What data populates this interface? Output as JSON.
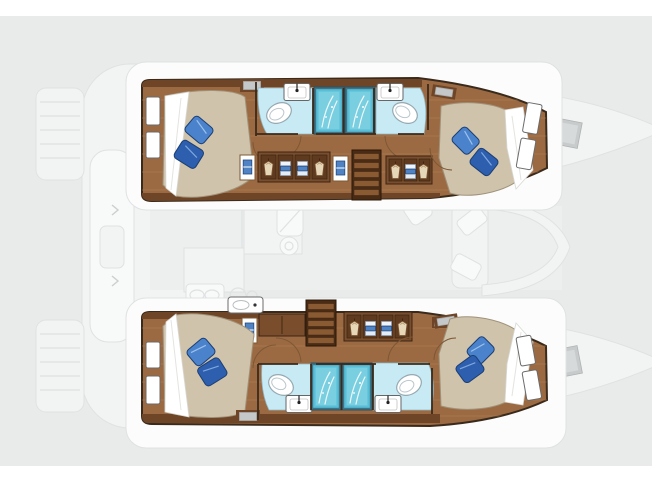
{
  "image": {
    "kind": "yacht-deck-plan",
    "description": "Top-down layout plan of a 4-cabin sailing catamaran; lower-deck hull interiors rendered in color over a ghosted main-deck outline",
    "visible_text": ""
  },
  "palette": {
    "background": "#e9ebea",
    "page_strip": "#ffffff",
    "deck_white": "#fcfcfc",
    "ghost_fill": "#f4f5f5",
    "ghost_line": "#dfe2e2",
    "wood": "#9c6a42",
    "wood_light": "#b4835a",
    "wood_dark": "#6e4526",
    "cabinet": "#7a4e2c",
    "wall": "#3a2a1b",
    "mattress": "#cfc3ac",
    "sheet": "#ffffff",
    "pillow_light": "#4a83cb",
    "pillow_dark": "#2d5fae",
    "bath_floor": "#c8eaf5",
    "shower_fill": "#57bfd8",
    "shower_pane": "#7fd0e2",
    "shower_frame": "#3f7386",
    "stairs_dark": "#4a2c14",
    "stairs_slat": "#8a5a33",
    "hatch_gray": "#c5c8c9",
    "fixture_white": "#ffffff"
  },
  "plan": {
    "hulls": [
      {
        "id": "upper-hull",
        "rooms": [
          {
            "name": "aft-double-cabin",
            "pillows": 2,
            "hull_windows": 2,
            "bed": "double-berth"
          },
          {
            "name": "aft-bathroom",
            "fixtures": [
              "toilet",
              "sink",
              "shower"
            ]
          },
          {
            "name": "fwd-bathroom",
            "fixtures": [
              "toilet",
              "sink",
              "shower"
            ]
          },
          {
            "name": "corridor",
            "features": [
              "wardrobe",
              "lockers",
              "companionway-stairs"
            ]
          },
          {
            "name": "fwd-double-cabin",
            "pillows": 2,
            "hull_windows": 2,
            "bed": "double-berth"
          }
        ]
      },
      {
        "id": "lower-hull",
        "rooms": [
          {
            "name": "aft-double-cabin",
            "pillows": 2,
            "hull_windows": 2,
            "bed": "double-berth"
          },
          {
            "name": "aft-bathroom",
            "fixtures": [
              "toilet",
              "sink",
              "shower"
            ]
          },
          {
            "name": "fwd-bathroom",
            "fixtures": [
              "toilet",
              "sink",
              "shower"
            ]
          },
          {
            "name": "corridor",
            "features": [
              "sink-unit",
              "wardrobe",
              "lockers",
              "companionway-stairs"
            ]
          },
          {
            "name": "fwd-double-cabin",
            "pillows": 2,
            "hull_windows": 2,
            "bed": "double-berth"
          }
        ]
      }
    ],
    "ghost_deck": [
      "transom-steps-port",
      "transom-steps-starboard",
      "aft-cockpit-bench",
      "salon-galley",
      "salon-table-seating",
      "bow-deck-hatches"
    ],
    "totals": {
      "cabins": 4,
      "bathrooms": 4,
      "showers": 4,
      "stair-flights": 2,
      "pillows": 8
    }
  }
}
